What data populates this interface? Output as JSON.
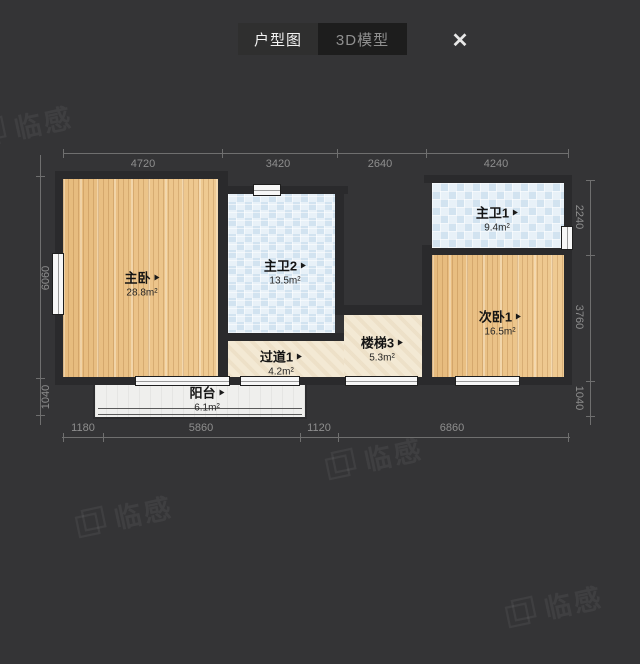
{
  "ui": {
    "tabs": [
      {
        "label": "户型图",
        "active": true
      },
      {
        "label": "3D模型",
        "active": false
      }
    ],
    "close_icon": "✕",
    "watermark_text": "临感"
  },
  "colors": {
    "background": "#343436",
    "wall": "#2a2a2c",
    "wood_floor": "#ebc387",
    "bath_tile": "#eef4f9",
    "hall_stone": "#f3e9d4",
    "balcony_floor": "#efefed",
    "dim_text": "#8e8e8e",
    "active_tab_bg": "#2f2f2f",
    "inactive_tab_bg": "#1d1d1d"
  },
  "floorplan": {
    "rooms": [
      {
        "name": "主卧",
        "area": "28.8m²"
      },
      {
        "name": "主卫2",
        "area": "13.5m²"
      },
      {
        "name": "主卫1",
        "area": "9.4m²"
      },
      {
        "name": "次卧1",
        "area": "16.5m²"
      },
      {
        "name": "过道1",
        "area": "4.2m²"
      },
      {
        "name": "楼梯3",
        "area": "5.3m²"
      },
      {
        "name": "阳台",
        "area": "6.1m²"
      }
    ],
    "dims": {
      "top": [
        "4720",
        "3420",
        "2640",
        "4240"
      ],
      "bottom": [
        "1180",
        "5860",
        "1120",
        "6860"
      ],
      "left": [
        "6060",
        "1040"
      ],
      "right": [
        "2240",
        "3760",
        "1040"
      ]
    }
  }
}
